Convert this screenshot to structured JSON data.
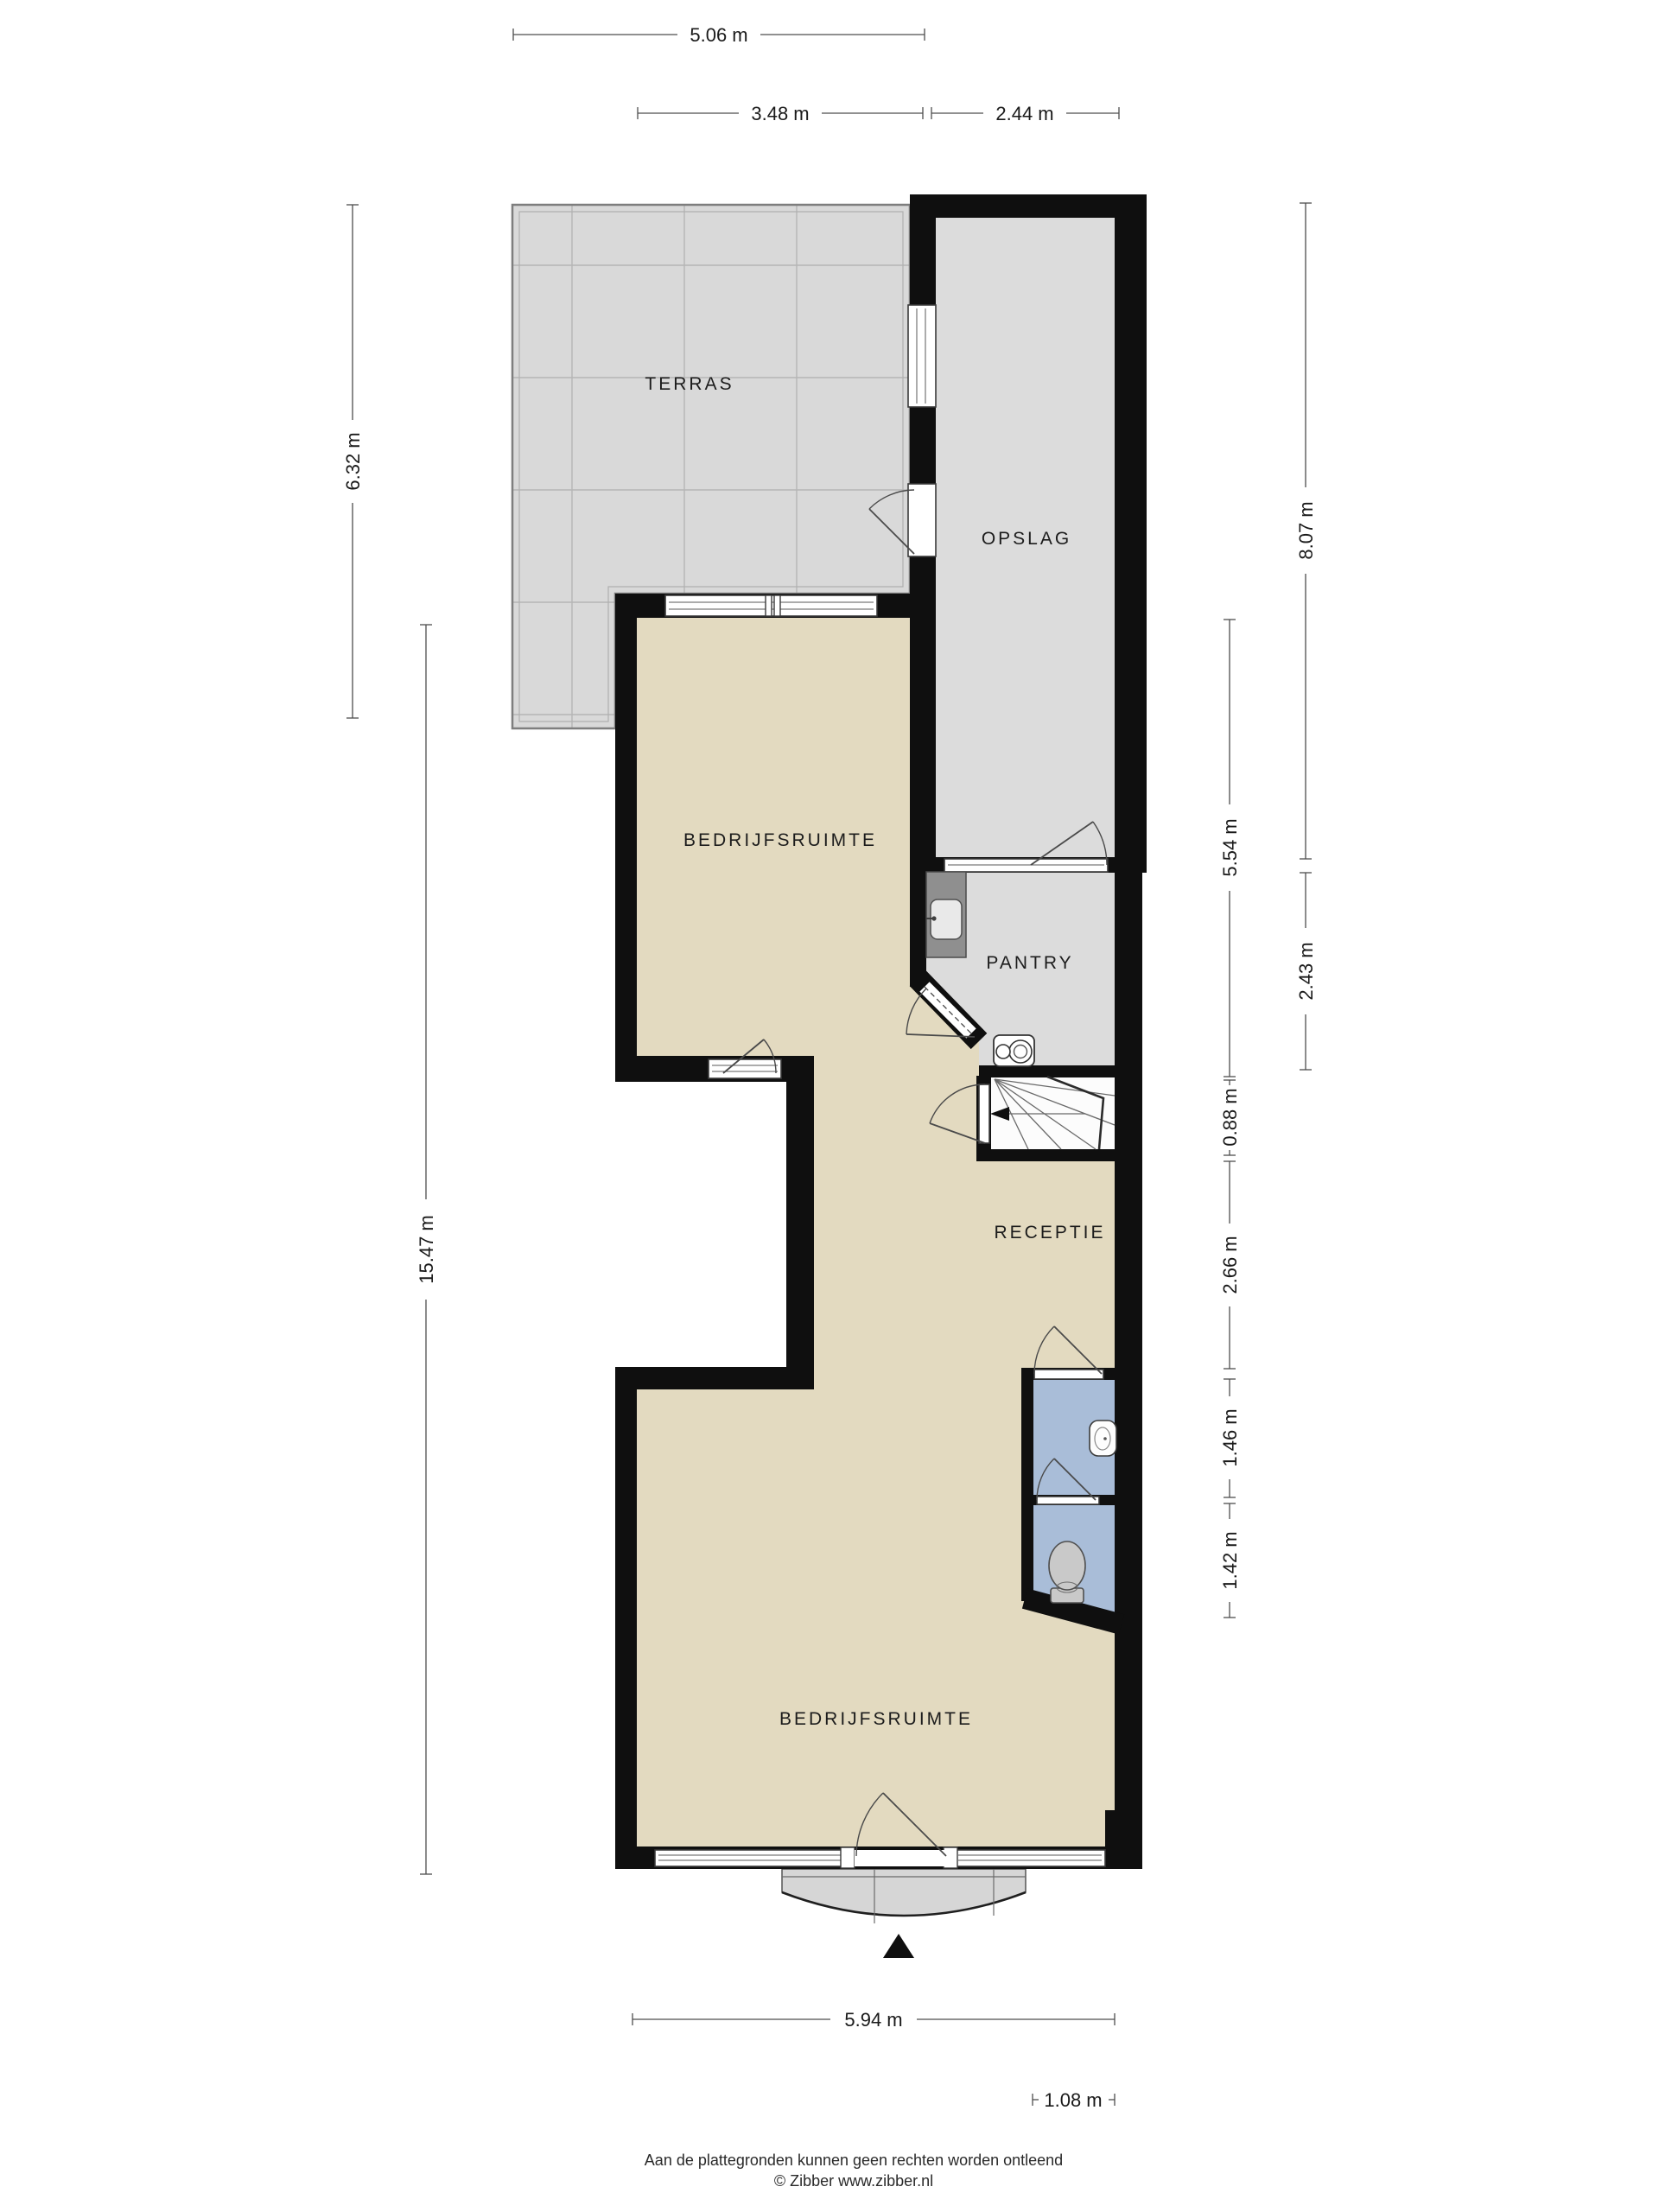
{
  "rooms": {
    "terras": "TERRAS",
    "opslag": "OPSLAG",
    "bedrijfsruimte_boven": "BEDRIJFSRUIMTE",
    "pantry": "PANTRY",
    "receptie": "RECEPTIE",
    "bedrijfsruimte_beneden": "BEDRIJFSRUIMTE"
  },
  "dimensions": {
    "top_total": "5.06 m",
    "top_left": "3.48 m",
    "top_right": "2.44 m",
    "left_terras": "6.32 m",
    "left_total": "15.47 m",
    "right_opslag": "8.07 m",
    "right_werkruimte": "5.54 m",
    "right_pantry": "2.43 m",
    "right_trap": "0.88 m",
    "right_receptie": "2.66 m",
    "right_toilet_boven": "1.46 m",
    "right_toilet_onder": "1.42 m",
    "bottom_total": "5.94 m",
    "bottom_entree": "1.08 m"
  },
  "footer": {
    "disclaimer": "Aan de plattegronden kunnen geen rechten worden ontleend",
    "credit": "© Zibber www.zibber.nl"
  },
  "colors": {
    "wall": "#0f0f0f",
    "floor_main": "#e3dac0",
    "floor_secondary": "#dcdcdc",
    "floor_wet": "#a9bdd8",
    "terras_tiles": "#d9d9d9",
    "canopy": "#d6d6d6"
  }
}
